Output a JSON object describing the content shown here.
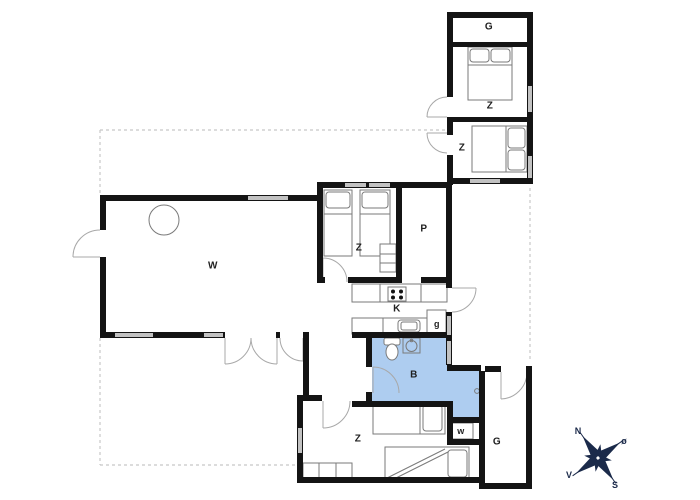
{
  "drawing": {
    "kind": "summer-house floor plan"
  },
  "colors": {
    "wall": "#141414",
    "window": "#c2c2c2",
    "bath": "#aecdf0",
    "door": "#a8a8a8",
    "furn": "#7a7a7a",
    "text": "#1f1f1f",
    "compass": "#1b2a4a",
    "dash": "#c8c8c8"
  },
  "rooms": {
    "annex_storage": {
      "label": "G"
    },
    "annex_bedroom_1": {
      "label": "Z"
    },
    "annex_bedroom_2": {
      "label": "Z"
    },
    "twin_bedroom": {
      "label": "Z"
    },
    "utility_room": {
      "label": "P"
    },
    "living_room": {
      "label": "W"
    },
    "kitchen": {
      "label": "K"
    },
    "pantry": {
      "label": "g"
    },
    "bathroom": {
      "label": "B"
    },
    "south_bedroom": {
      "label": "Z"
    },
    "closet": {
      "label": "w"
    },
    "garage": {
      "label": "G"
    }
  },
  "compass": {
    "north": "N",
    "east": "ø",
    "south": "S",
    "west": "V"
  }
}
